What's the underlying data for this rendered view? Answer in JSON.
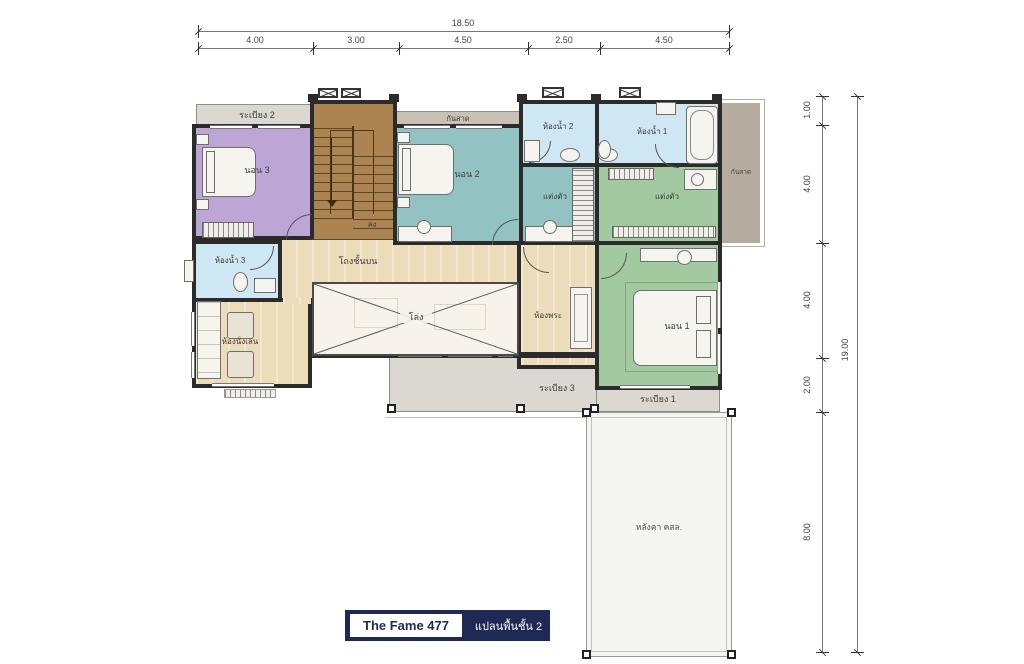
{
  "plan": {
    "title": "The Fame 477",
    "subtitle": "แปลนพื้นชั้น 2"
  },
  "dims": {
    "top_total": "18.50",
    "top_segments": [
      "4.00",
      "3.00",
      "4.50",
      "2.50",
      "4.50"
    ],
    "right_total": "19.00",
    "right_segments": [
      "1.00",
      "4.00",
      "4.00",
      "2.00",
      "8.00"
    ]
  },
  "labels": {
    "balcony2": "ระเบียง 2",
    "balcony3": "ระเบียง 3",
    "balcony1": "ระเบียง 1",
    "bedroom3": "นอน 3",
    "bedroom2": "นอน 2",
    "bedroom1": "นอน 1",
    "bath3": "ห้องน้ำ 3",
    "bath2": "ห้องน้ำ 2",
    "bath1": "ห้องน้ำ 1",
    "dressing_a": "แต่งตัว",
    "dressing_b": "แต่งตัว",
    "awning_top": "กันสาด",
    "awning_right": "กันสาด",
    "hall": "โถงชั้นบน",
    "void": "โล่ง",
    "stairs_down": "ลง",
    "prayer": "ห้องพระ",
    "living": "ห้องนั่งเล่น",
    "roof": "หลังคา คสล."
  },
  "colors": {
    "wall": "#2b2b2b",
    "wood": "#ecdcb9",
    "balcony": "#dbd8d2",
    "awning": "#b5ac9e",
    "bedroom3": "#bda6d6",
    "bedroom2": "#93c2c3",
    "bedroom1": "#a3c9a0",
    "bathroom": "#cfe6f3",
    "stairs": "#ab8452",
    "navy": "#1e2a55"
  }
}
